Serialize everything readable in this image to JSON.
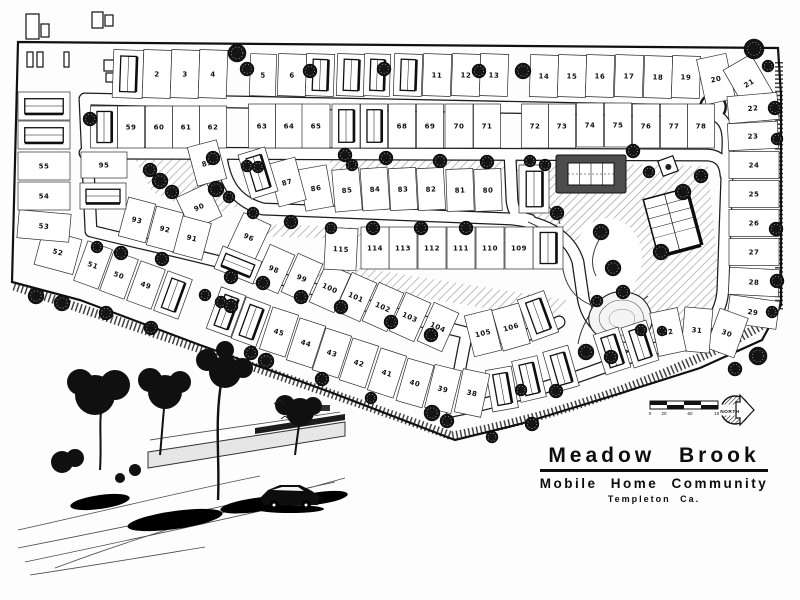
{
  "title_block": {
    "name": "Meadow Brook",
    "subtitle": "Mobile Home Community",
    "location": "Templeton Ca."
  },
  "compass": {
    "label": "NORTH"
  },
  "scale_bar": {
    "labels": [
      "0",
      "20",
      "60",
      "100"
    ]
  },
  "site": {
    "community_type": "mobile home park site plan",
    "lot_count": 115,
    "lots": [
      [
        1,
        128,
        74,
        30,
        48,
        2,
        1
      ],
      [
        2,
        157,
        74,
        28,
        48,
        2,
        0
      ],
      [
        3,
        185,
        74,
        28,
        48,
        2,
        0
      ],
      [
        4,
        213,
        74,
        28,
        48,
        2,
        0
      ],
      [
        5,
        263,
        75,
        26,
        42,
        2,
        0
      ],
      [
        6,
        292,
        75,
        28,
        42,
        2,
        0
      ],
      [
        7,
        320,
        75,
        28,
        42,
        2,
        1
      ],
      [
        8,
        351,
        75,
        28,
        42,
        2,
        1
      ],
      [
        9,
        377,
        75,
        26,
        42,
        2,
        1
      ],
      [
        10,
        408,
        75,
        28,
        42,
        2,
        1
      ],
      [
        11,
        437,
        75,
        28,
        42,
        2,
        0
      ],
      [
        12,
        466,
        75,
        28,
        42,
        2,
        0
      ],
      [
        13,
        494,
        75,
        28,
        42,
        2,
        0
      ],
      [
        14,
        544,
        76,
        28,
        42,
        2,
        0
      ],
      [
        15,
        572,
        76,
        28,
        42,
        2,
        0
      ],
      [
        16,
        600,
        76,
        28,
        42,
        2,
        0
      ],
      [
        17,
        629,
        76,
        28,
        42,
        2,
        0
      ],
      [
        18,
        658,
        77,
        28,
        42,
        2,
        0
      ],
      [
        19,
        686,
        77,
        28,
        42,
        2,
        0
      ],
      [
        20,
        716,
        79,
        30,
        46,
        -12,
        0
      ],
      [
        21,
        749,
        83,
        32,
        48,
        -30,
        0
      ],
      [
        22,
        753,
        108,
        50,
        27,
        -5,
        0
      ],
      [
        23,
        753,
        136,
        50,
        27,
        -3,
        0
      ],
      [
        24,
        754,
        165,
        50,
        27,
        0,
        0
      ],
      [
        25,
        754,
        194,
        50,
        27,
        0,
        0
      ],
      [
        26,
        754,
        223,
        50,
        27,
        0,
        0
      ],
      [
        27,
        754,
        252,
        50,
        27,
        0,
        0
      ],
      [
        28,
        754,
        282,
        50,
        27,
        3,
        0
      ],
      [
        29,
        753,
        312,
        50,
        28,
        8,
        0
      ],
      [
        30,
        727,
        333,
        30,
        42,
        20,
        0
      ],
      [
        31,
        697,
        330,
        28,
        44,
        5,
        0
      ],
      [
        32,
        668,
        332,
        28,
        44,
        -12,
        0
      ],
      [
        33,
        640,
        344,
        26,
        42,
        -18,
        1
      ],
      [
        34,
        612,
        351,
        26,
        42,
        -18,
        1
      ],
      [
        35,
        561,
        369,
        26,
        42,
        -16,
        1
      ],
      [
        36,
        529,
        379,
        26,
        42,
        -13,
        1
      ],
      [
        37,
        502,
        389,
        26,
        42,
        -10,
        1
      ],
      [
        38,
        472,
        393,
        27,
        44,
        12,
        0
      ],
      [
        39,
        443,
        389,
        27,
        44,
        14,
        0
      ],
      [
        40,
        415,
        383,
        27,
        44,
        16,
        0
      ],
      [
        41,
        387,
        373,
        27,
        44,
        18,
        0
      ],
      [
        42,
        359,
        363,
        27,
        44,
        18,
        0
      ],
      [
        43,
        332,
        353,
        27,
        44,
        18,
        0
      ],
      [
        44,
        306,
        343,
        27,
        44,
        18,
        0
      ],
      [
        45,
        279,
        332,
        27,
        44,
        18,
        0
      ],
      [
        46,
        251,
        322,
        26,
        44,
        20,
        1
      ],
      [
        47,
        226,
        312,
        26,
        44,
        20,
        1
      ],
      [
        48,
        173,
        295,
        26,
        42,
        20,
        1
      ],
      [
        49,
        146,
        285,
        26,
        42,
        20,
        0
      ],
      [
        50,
        119,
        275,
        26,
        42,
        20,
        0
      ],
      [
        51,
        93,
        265,
        26,
        42,
        20,
        0
      ],
      [
        52,
        58,
        252,
        40,
        36,
        15,
        0
      ],
      [
        53,
        44,
        226,
        52,
        28,
        5,
        0
      ],
      [
        54,
        44,
        196,
        52,
        28,
        0,
        0
      ],
      [
        55,
        44,
        166,
        52,
        28,
        0,
        0
      ],
      [
        56,
        44,
        135,
        52,
        28,
        0,
        1
      ],
      [
        57,
        44,
        106,
        52,
        28,
        0,
        1
      ],
      [
        58,
        104,
        127,
        27,
        42,
        0,
        1
      ],
      [
        59,
        131,
        127,
        27,
        42,
        0,
        0
      ],
      [
        60,
        159,
        127,
        27,
        42,
        0,
        0
      ],
      [
        61,
        186,
        127,
        27,
        42,
        0,
        0
      ],
      [
        62,
        213,
        127,
        27,
        42,
        0,
        0
      ],
      [
        63,
        262,
        126,
        27,
        44,
        0,
        0
      ],
      [
        64,
        289,
        126,
        27,
        44,
        0,
        0
      ],
      [
        65,
        316,
        126,
        28,
        44,
        0,
        0
      ],
      [
        66,
        346,
        126,
        28,
        44,
        0,
        1
      ],
      [
        67,
        374,
        126,
        27,
        44,
        0,
        1
      ],
      [
        68,
        402,
        126,
        27,
        44,
        0,
        0
      ],
      [
        69,
        430,
        126,
        27,
        44,
        0,
        0
      ],
      [
        70,
        459,
        126,
        28,
        44,
        0,
        0
      ],
      [
        71,
        487,
        126,
        27,
        44,
        0,
        0
      ],
      [
        72,
        535,
        126,
        27,
        44,
        0,
        0
      ],
      [
        73,
        562,
        126,
        27,
        44,
        0,
        0
      ],
      [
        74,
        590,
        125,
        27,
        44,
        0,
        0
      ],
      [
        75,
        618,
        125,
        27,
        44,
        0,
        0
      ],
      [
        76,
        646,
        126,
        27,
        44,
        0,
        0
      ],
      [
        77,
        674,
        126,
        27,
        44,
        0,
        0
      ],
      [
        78,
        701,
        126,
        27,
        44,
        0,
        0
      ],
      [
        79,
        534,
        189,
        30,
        48,
        0,
        1
      ],
      [
        80,
        488,
        190,
        27,
        42,
        -2,
        0
      ],
      [
        81,
        460,
        190,
        27,
        42,
        -2,
        0
      ],
      [
        82,
        431,
        189,
        27,
        42,
        -3,
        0
      ],
      [
        83,
        403,
        189,
        27,
        42,
        -3,
        0
      ],
      [
        84,
        375,
        189,
        27,
        42,
        -4,
        0
      ],
      [
        85,
        347,
        190,
        27,
        42,
        -5,
        0
      ],
      [
        86,
        316,
        188,
        28,
        42,
        -10,
        0
      ],
      [
        87,
        287,
        182,
        28,
        44,
        -15,
        0
      ],
      [
        88,
        258,
        173,
        28,
        46,
        -17,
        1
      ],
      [
        89,
        207,
        163,
        30,
        40,
        -15,
        0
      ],
      [
        90,
        199,
        207,
        34,
        36,
        -25,
        0
      ],
      [
        91,
        192,
        238,
        30,
        38,
        15,
        0
      ],
      [
        92,
        165,
        229,
        28,
        40,
        15,
        0
      ],
      [
        93,
        137,
        220,
        28,
        40,
        15,
        0
      ],
      [
        94,
        103,
        196,
        46,
        26,
        0,
        1
      ],
      [
        95,
        104,
        165,
        46,
        26,
        0,
        0
      ],
      [
        96,
        249,
        237,
        30,
        40,
        25,
        0
      ],
      [
        97,
        238,
        265,
        42,
        24,
        22,
        1
      ],
      [
        98,
        274,
        269,
        27,
        42,
        24,
        0
      ],
      [
        99,
        302,
        278,
        27,
        42,
        24,
        0
      ],
      [
        100,
        330,
        288,
        27,
        42,
        24,
        0
      ],
      [
        101,
        356,
        297,
        27,
        42,
        24,
        0
      ],
      [
        102,
        383,
        307,
        27,
        42,
        24,
        0
      ],
      [
        103,
        410,
        317,
        27,
        42,
        24,
        0
      ],
      [
        104,
        438,
        327,
        27,
        42,
        24,
        0
      ],
      [
        105,
        483,
        333,
        28,
        42,
        -14,
        0
      ],
      [
        106,
        511,
        327,
        28,
        42,
        -16,
        0
      ],
      [
        107,
        538,
        316,
        28,
        44,
        -20,
        1
      ],
      [
        108,
        548,
        248,
        30,
        42,
        0,
        1
      ],
      [
        109,
        519,
        248,
        28,
        42,
        0,
        0
      ],
      [
        110,
        490,
        248,
        28,
        42,
        0,
        0
      ],
      [
        111,
        461,
        248,
        28,
        42,
        0,
        0
      ],
      [
        112,
        432,
        248,
        28,
        42,
        0,
        0
      ],
      [
        113,
        403,
        248,
        28,
        42,
        0,
        0
      ],
      [
        114,
        375,
        248,
        28,
        42,
        0,
        0
      ],
      [
        115,
        341,
        249,
        32,
        42,
        3,
        0
      ]
    ],
    "trees": [
      [
        237,
        53,
        9
      ],
      [
        247,
        69,
        7
      ],
      [
        310,
        71,
        7
      ],
      [
        384,
        69,
        7
      ],
      [
        479,
        71,
        7
      ],
      [
        523,
        71,
        8
      ],
      [
        754,
        49,
        10
      ],
      [
        768,
        66,
        6
      ],
      [
        775,
        108,
        7
      ],
      [
        777,
        139,
        6
      ],
      [
        776,
        229,
        7
      ],
      [
        777,
        281,
        7
      ],
      [
        772,
        312,
        6
      ],
      [
        758,
        356,
        9
      ],
      [
        735,
        369,
        7
      ],
      [
        90,
        119,
        7
      ],
      [
        213,
        158,
        7
      ],
      [
        258,
        167,
        6
      ],
      [
        345,
        155,
        7
      ],
      [
        352,
        165,
        6
      ],
      [
        386,
        158,
        7
      ],
      [
        440,
        161,
        7
      ],
      [
        487,
        162,
        7
      ],
      [
        530,
        161,
        6
      ],
      [
        150,
        170,
        7
      ],
      [
        160,
        181,
        8
      ],
      [
        172,
        192,
        7
      ],
      [
        216,
        189,
        8
      ],
      [
        229,
        197,
        6
      ],
      [
        247,
        166,
        6
      ],
      [
        253,
        213,
        6
      ],
      [
        291,
        222,
        7
      ],
      [
        331,
        228,
        6
      ],
      [
        373,
        228,
        7
      ],
      [
        421,
        228,
        7
      ],
      [
        466,
        228,
        7
      ],
      [
        97,
        247,
        6
      ],
      [
        121,
        253,
        7
      ],
      [
        162,
        259,
        7
      ],
      [
        231,
        277,
        7
      ],
      [
        263,
        283,
        7
      ],
      [
        301,
        297,
        7
      ],
      [
        341,
        307,
        7
      ],
      [
        391,
        322,
        7
      ],
      [
        431,
        335,
        7
      ],
      [
        205,
        295,
        6
      ],
      [
        221,
        302,
        6
      ],
      [
        36,
        296,
        8
      ],
      [
        62,
        303,
        8
      ],
      [
        106,
        313,
        7
      ],
      [
        151,
        328,
        7
      ],
      [
        231,
        306,
        7
      ],
      [
        251,
        353,
        7
      ],
      [
        266,
        361,
        8
      ],
      [
        322,
        379,
        7
      ],
      [
        371,
        398,
        6
      ],
      [
        432,
        413,
        8
      ],
      [
        447,
        421,
        7
      ],
      [
        492,
        437,
        6
      ],
      [
        532,
        424,
        7
      ],
      [
        556,
        391,
        7
      ],
      [
        586,
        352,
        8
      ],
      [
        611,
        357,
        7
      ],
      [
        521,
        390,
        6
      ],
      [
        601,
        232,
        8
      ],
      [
        613,
        268,
        8
      ],
      [
        623,
        292,
        7
      ],
      [
        557,
        213,
        7
      ],
      [
        661,
        252,
        8
      ],
      [
        683,
        192,
        8
      ],
      [
        701,
        176,
        7
      ],
      [
        633,
        151,
        7
      ],
      [
        649,
        172,
        6
      ],
      [
        597,
        301,
        6
      ],
      [
        545,
        165,
        6
      ],
      [
        641,
        330,
        6
      ],
      [
        662,
        331,
        5
      ]
    ]
  }
}
